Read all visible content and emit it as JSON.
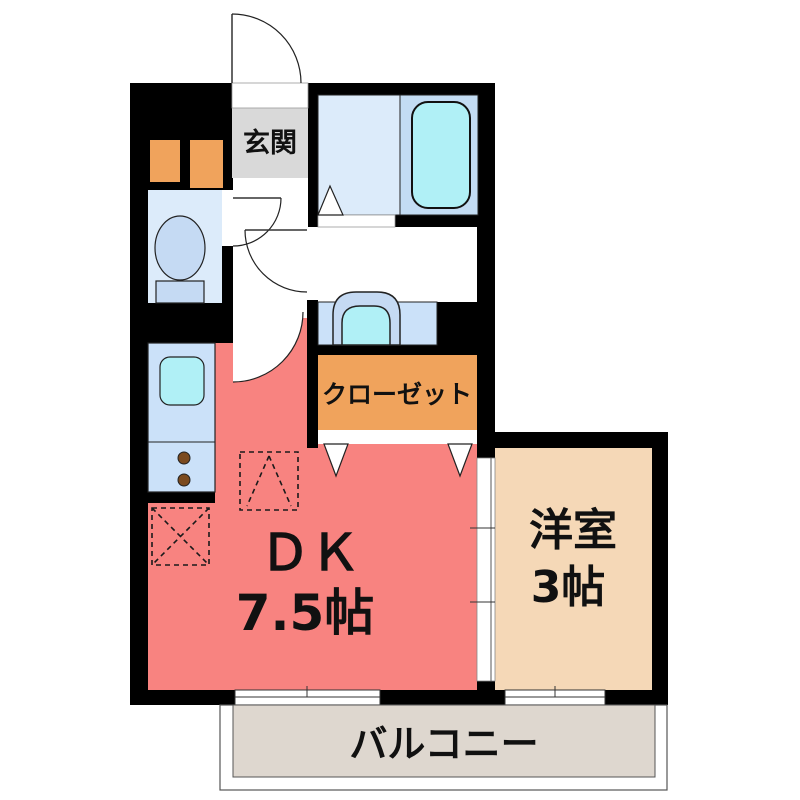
{
  "floorplan": {
    "labels": {
      "genkan": "玄関",
      "closet": "クローゼット",
      "dk_name": "ＤＫ",
      "dk_size": "7.5帖",
      "western_room_name": "洋室",
      "western_room_size": "3帖",
      "balcony": "バルコニー"
    },
    "colors": {
      "wall": "#000000",
      "dk_floor": "#F88380",
      "western_room_floor": "#F5D8B7",
      "closet_fill": "#F0A35C",
      "genkan_floor": "#D9D9D9",
      "balcony_floor": "#DED7CF",
      "wet_area_floor": "#DCEBFA",
      "bathtub_zone": "#C3DCF3",
      "bathtub_fill": "#B0F0F6",
      "fixture_blue": "#C5DAF3",
      "counter_blue": "#CBE1F9",
      "sink_cyan": "#B0F0F6",
      "burner_brown": "#7B4A1F"
    },
    "fixtures": {
      "entrance_door": "swing-door-arc",
      "interior_doors": "swing-door-arcs",
      "bath_door": "folding-door-triangle",
      "closet_doors": "folding-door-triangles",
      "bathtub": "bathtub-symbol",
      "toilet": "toilet-symbol",
      "washbasin": "washbasin-symbol",
      "kitchen_sink": "kitchen-sink-symbol",
      "stove_burners": "two-burner-dots",
      "refrigerator_space": "dashed-square-triangle",
      "washing_machine_space": "dashed-square-x",
      "windows": "sliding-window-symbols",
      "partition": "sliding-door-track"
    }
  }
}
